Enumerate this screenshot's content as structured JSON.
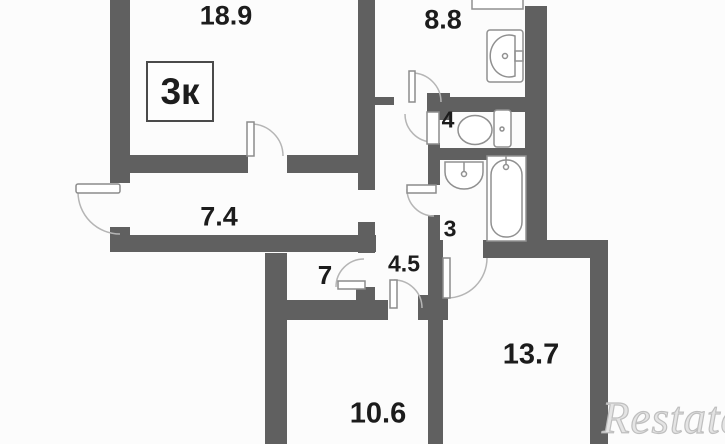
{
  "plan": {
    "type_label": "3к",
    "rooms": [
      {
        "name": "living-room",
        "area": "18.9"
      },
      {
        "name": "kitchen",
        "area": "8.8"
      },
      {
        "name": "hallway",
        "area": "7.4"
      },
      {
        "name": "storage",
        "area": "7"
      },
      {
        "name": "hall",
        "area": "4.5"
      },
      {
        "name": "wc",
        "area": "4"
      },
      {
        "name": "bathroom",
        "area": "3"
      },
      {
        "name": "room-13",
        "area": "13.7"
      },
      {
        "name": "room-10",
        "area": "10.6"
      }
    ],
    "fixtures": [
      "counter",
      "kitchen-sink",
      "toilet",
      "wash-basin",
      "bathtub"
    ],
    "colors": {
      "wall": "#606060",
      "label": "#1c1c1c",
      "door_arc": "#b5b5b5",
      "watermark": "#bfbfbf"
    }
  },
  "watermark": {
    "text": "Restate"
  }
}
